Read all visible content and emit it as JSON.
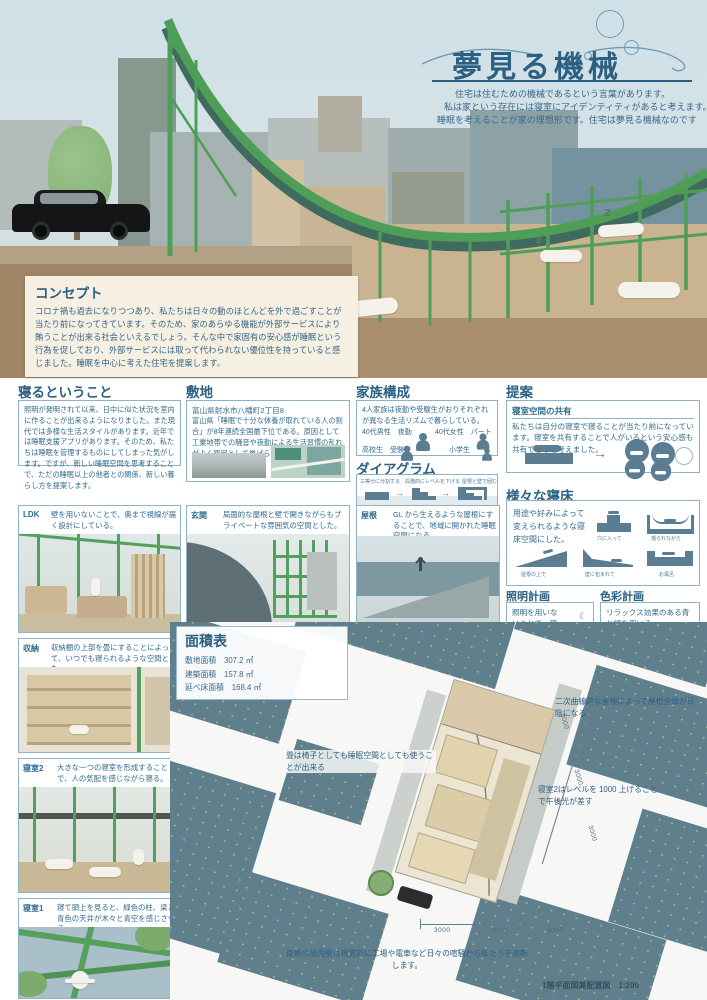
{
  "poster": {
    "title": "夢見る機械",
    "subtitle_lines": [
      "住宅は住むための機械であるという言葉があります。",
      "私は家という存在には寝室にアイデンティティがあると考えます。",
      "睡眠を考えることが家の理想形です。住宅は夢見る機械なのです"
    ]
  },
  "scene": {
    "z": [
      "z",
      "z",
      "Z"
    ]
  },
  "concept": {
    "heading": "コンセプト",
    "body": "コロナ禍も過去になりつつあり、私たちは日々の動のほとんどを外で過ごすことが当たり前になってきています。そのため、家のあらゆる機能が外部サービスにより賄うことが出来る社会といえるでしょう。そんな中で家固有の安心感が睡眠という行為を促しており、外部サービスには取って代わられない優位性を持っていると感じました。睡眠を中心に考えた住宅を提案します。"
  },
  "sleeping": {
    "heading": "寝るということ",
    "body": "照明が発明されて以来、日中に似た状況を室内に作ることが出来るようになりました。また現代では多様な生活スタイルがあります。近年では睡眠支援アプリがあります。そのため、私たちは睡眠を管理するものにしてしまった気がします。ですが、新しい睡眠空間を思考することで、ただの睡眠以上の他者との関係、新しい暮らし方を提案します。"
  },
  "site": {
    "heading": "敷地",
    "address": "富山県射水市八幡町2丁目8",
    "body": "富山県「睡眠で十分な休養が取れている人の割合」が8年連続全国最下位である。原因として工業地帯での騒音や夜勤による生活習慣の乱れがよく原因として挙げられることからこの敷地を選定した。"
  },
  "family": {
    "heading": "家族構成",
    "body": "4人家族は夜勤や受験生がおりそれぞれが異なる生活リズムで暮らしている。",
    "members": [
      "40代男性　夜勤",
      "40代女性　パート",
      "高校生　受験生",
      "小学生"
    ]
  },
  "proposal": {
    "heading": "提案",
    "sub_heading": "寝室空間の共有",
    "body": "私たちは自分の寝室で寝ることが当たり前になっています。寝室を共有することで人がいるという安心感も共有できると考えました。",
    "arrow": "→"
  },
  "diagram": {
    "heading": "ダイアグラム",
    "steps": [
      "三等分に分割する",
      "段階的にレベルを下げる",
      "屋根と壁で囲む"
    ],
    "arrow": "→"
  },
  "beds": {
    "heading": "様々な寝床",
    "body": "用途や好みによって変えられるような寝床空間にした。",
    "variants": [
      "穴に入って",
      "揺られながら",
      "屋根の上で",
      "壁に包まれて",
      "お風呂"
    ]
  },
  "lighting": {
    "heading": "照明計画",
    "body": "照明を用いないことで、寝やすい空間を作り出す。",
    "umbrella_icon": "☂",
    "moon_icon": "☾"
  },
  "color_plan": {
    "heading": "色彩計画",
    "body": "リラックス効果のある青と緑を用いる。",
    "swatches": [
      "#8ca7c2",
      "#93b88c"
    ]
  },
  "rooms": [
    {
      "label": "LDK",
      "caption": "壁を用いないことで、奥まで視線が届く設計にしている。"
    },
    {
      "label": "玄関",
      "caption": "局面的な屋根と壁で開きながらもプライベートな雰囲気の空間とした。"
    },
    {
      "label": "屋根",
      "caption": "GL から生えるような屋根にすることで、地域に開かれた睡眠空間になる。"
    },
    {
      "label": "収納",
      "caption": "収納棚の上部を畳にすることによって、いつでも寝られるような空間とした。"
    },
    {
      "label": "寝室2",
      "caption": "大きな一つの寝室を形成することで、人の気配を感じながら寝る。"
    },
    {
      "label": "寝室1",
      "caption": "寝て頭上を見ると、緑色の柱、梁と青色の天井が木々と青空を感じさせる。"
    }
  ],
  "area_table": {
    "heading": "面積表",
    "rows": [
      {
        "label": "敷地面積",
        "value": "307.2 ㎡"
      },
      {
        "label": "建築面積",
        "value": "157.8 ㎡"
      },
      {
        "label": "延べ床面積",
        "value": "168.4 ㎡"
      }
    ]
  },
  "plan": {
    "notes": [
      "二次曲線的な屋根によって屋根全体が日陰になる",
      "畳は椅子としても睡眠空間としても使うことが出来る",
      "寝室2はレベルを 1000 上げることで午後光が差す",
      "南側の局面壁は視覚的に工場や電車など日々の喧騒から私たちを遮断します。"
    ],
    "dims": [
      "3000",
      "3000",
      "3000",
      "3000",
      "3000",
      "3000"
    ],
    "caption": "1階平面図兼配置図　1:200"
  },
  "colors": {
    "accent_blue": "#2c6083",
    "frame_green": "#53a05c",
    "slate": "#5a7d92",
    "block_slate": "#607f8d",
    "cream": "#f6f0e2",
    "tan": "#c9b391"
  }
}
